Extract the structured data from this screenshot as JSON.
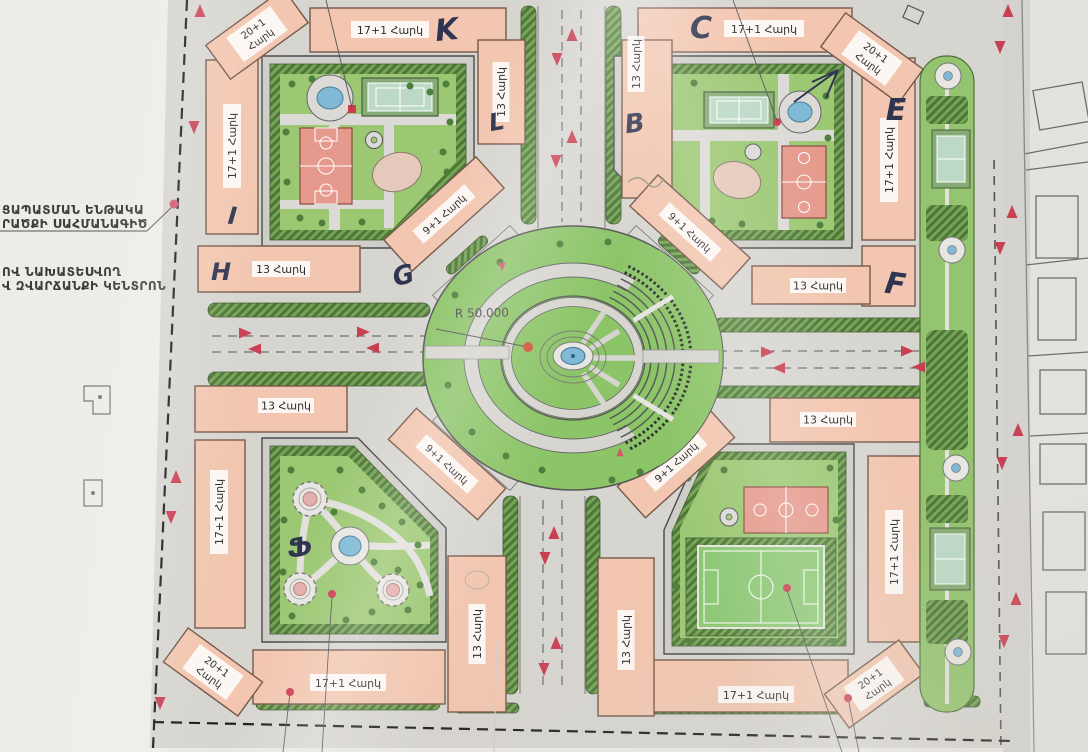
{
  "plan": {
    "radius_label": "R 50.000",
    "floor_labels": {
      "f17": "17+1 Հարկ",
      "f13": "13 Հարկ",
      "f9": "9+1 Հարկ",
      "f20_line1": "20+1",
      "f20_line2": "Հարկ"
    },
    "handwritten": {
      "K": "K",
      "L": "L",
      "I": "I",
      "H": "H",
      "G": "G",
      "B": "B",
      "C": "C",
      "E": "E",
      "F": "F",
      "park_mark": "Ֆ"
    },
    "margin_notes": {
      "note1_line1": "ՑԱՊԱՏՄԱՆ ԵՆԹԱԿԱ",
      "note1_line2": "ՐԱԾՔԻ ՍԱՀՄԱՆԱԳԻԾ",
      "note2_line1": "ՈՎ ՆԱԽԱՏԵՍՎՈՂ",
      "note2_line2": "Վ ԶՎԱՐՃԱՆՔԻ ԿԵՆՏՐՈՆ"
    },
    "colors": {
      "building": "#f2c6b0",
      "park_green": "#8cc468",
      "court_pink": "#e59a8d",
      "pool_blue": "#7fb9d6",
      "road_gray": "#d7d5d0",
      "arrow_red": "#c94053",
      "ink": "#2f3550"
    }
  }
}
